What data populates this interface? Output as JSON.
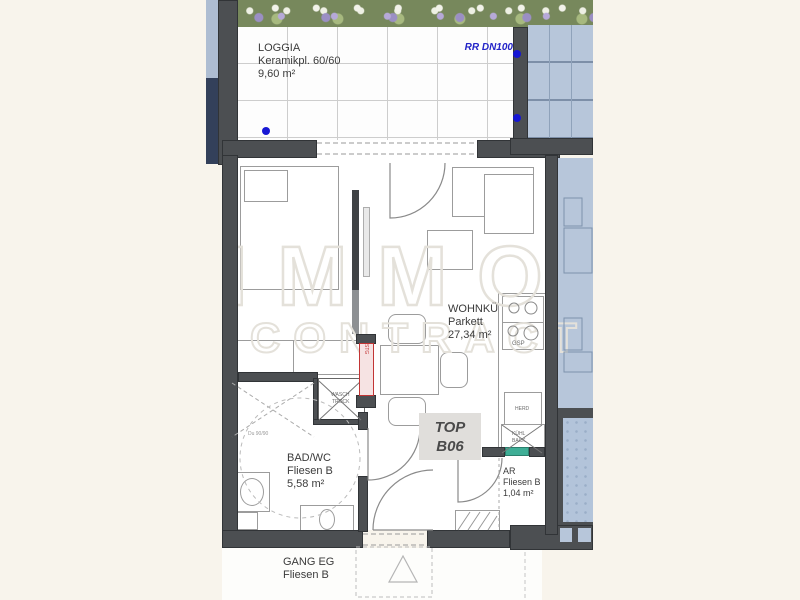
{
  "watermark": {
    "line1": "IMMO",
    "line2": "CONTRACT"
  },
  "rooms": {
    "loggia": {
      "name": "LOGGIA",
      "finish": "Keramikpl. 60/60",
      "area": "9,60 m²"
    },
    "wohnkueche": {
      "name": "WOHNKÜ",
      "finish": "Parkett",
      "area": "27,34 m²"
    },
    "bad": {
      "name": "BAD/WC",
      "finish": "Fliesen B",
      "area": "5,58 m²"
    },
    "ar": {
      "name": "AR",
      "finish": "Fliesen B",
      "area": "1,04 m²"
    },
    "gang": {
      "name": "GANG EG",
      "finish": "Fliesen B"
    }
  },
  "unit": {
    "prefix": "TOP",
    "number": "B06"
  },
  "labels": {
    "drainpipe": "RR DN100",
    "dishwasher": "GSP",
    "stove": "HERD",
    "fridge_top": "KÜHL",
    "fridge_bottom": "BACK",
    "washer": "WASCH",
    "dryer": "TROCK",
    "shaft": "STG",
    "shower": "Du 90/90"
  },
  "colors": {
    "background": "#f8f4ec",
    "wall": "#4c4f52",
    "neighbor_fill": "#b7c6da",
    "accent_blue": "#1717d4",
    "accent_red": "#c23535",
    "accent_green": "#3fae96"
  }
}
